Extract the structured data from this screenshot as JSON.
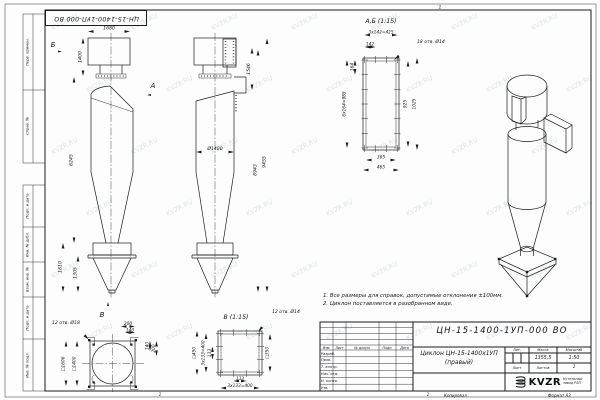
{
  "sheet": {
    "watermark": "KVZR.RU",
    "stamp_top": "ЦН-15-1400-1УП-000 ВО",
    "fold_mark_top": "1",
    "fold_mark_bottom_left": "1",
    "fold_mark_bottom_right": "1",
    "copied_label": "Копировал",
    "format_label": "Формат А3",
    "margin_fields": [
      "Перв. примен.",
      "Справ. №",
      "Подп. и дата",
      "Инв. № дубл.",
      "Взам. инв. №",
      "Подп. и дата",
      "Инв. № подл."
    ]
  },
  "notes": {
    "line1": "1. Все размеры для справок, допустимые отклонения ±100мм.",
    "line2": "2. Циклон поставляется в разобранном виде."
  },
  "views": {
    "front": {
      "label_a": "А",
      "label_b": "Б",
      "label_v": "В",
      "dims": {
        "top_width": "1680",
        "inlet_height": "1400",
        "body_height": "6245",
        "hopper_height": "1810",
        "hopper_cone_height": "1305"
      }
    },
    "side": {
      "dims": {
        "duct_height": "1546",
        "body_diameter": "Ø1400",
        "height_to_inlet": "8943",
        "total_height": "9455"
      }
    },
    "section_ab": {
      "title": "А,Б (1:15)",
      "holes_note": "18 отв. Ø14",
      "dims": {
        "hole_pitch_row": "3х142=425",
        "hole_pitch_one": "142",
        "edge_offset": "164",
        "hole_pitch_col": "6х164=985",
        "opening_height": "925",
        "flange_height": "1025",
        "opening_width": "365",
        "flange_width": "465"
      }
    },
    "bottom": {
      "holes_note": "12 отв. Ø18",
      "dims": {
        "outer_square": "□1606",
        "inner_square": "□1400",
        "corner_top_200": "200",
        "corner_top_140": "140",
        "corner_right_140": "140",
        "corner_right_200": "200"
      }
    },
    "section_v": {
      "title": "В (1:15)",
      "holes_note": "12 отв. Ø14",
      "dims": {
        "flange_square": "□450",
        "opening_square": "□350",
        "pitch_col": "3х133=400",
        "pitch_one_col": "133",
        "pitch_one_row": "133",
        "pitch_row": "3х133=400"
      }
    }
  },
  "title_block": {
    "doc_number": "ЦН-15-1400-1УП-000 ВО",
    "product_name_line1": "Циклон ЦН-15-1400х1УП",
    "product_name_line2": "(правый)",
    "header_cols": {
      "izm": "Изм.",
      "list": "Лист",
      "doc": "№ докум.",
      "podp": "Подп.",
      "data": "Дата"
    },
    "rows": {
      "r1": "Разраб.",
      "r2": "Пров.",
      "r3": "Т. контр.",
      "r4": "Нач. отд.",
      "r5": "Н. контр.",
      "r6": "Утв."
    },
    "lit_label": "Лит.",
    "mass_label": "Масса",
    "scale_label": "Масштаб",
    "mass_value": "1355,5",
    "scale_value": "1:50",
    "sheet_label": "Лист",
    "sheets_label": "Листов",
    "sheets_value": "1",
    "logo_text": "KVZR",
    "company_line1": "Котельный",
    "company_line2": "завод РЭП"
  }
}
